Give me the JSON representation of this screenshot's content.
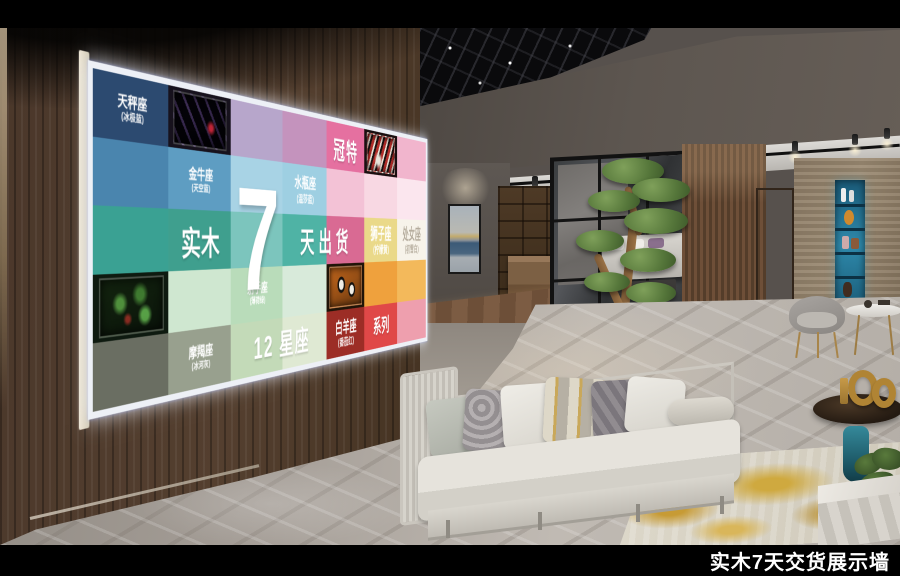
{
  "caption": "实木7天交货展示墙",
  "board": {
    "brand": "冠特",
    "headline_left": "实木",
    "headline_number": "7",
    "headline_right": "天出货",
    "footer_line": "12 星座",
    "series": "系列",
    "frame_color": "#edf0f6",
    "rows": [
      [
        {
          "c": "#2c4a70",
          "l": "天秤座",
          "s": "(冰极蓝)"
        },
        {
          "c": "#17121d",
          "n": "stripe-dark"
        },
        {
          "c": "#b7a6cb"
        },
        {
          "c": "#c493bd"
        },
        {
          "c": "#e570a0"
        },
        {
          "c": "#1a0f10",
          "n": "stripe-red"
        },
        {
          "c": "#f1b5cd"
        }
      ],
      [
        {
          "c": "#4a85ae"
        },
        {
          "c": "#5e9dc2",
          "l": "金牛座",
          "s": "(天空蓝)"
        },
        {
          "c": "#a8d3e5"
        },
        {
          "c": "#9ecfe2",
          "l": "水瓶座",
          "s": "(温莎蓝)"
        },
        {
          "c": "#f3c2d6"
        },
        {
          "c": "#f8d8e3"
        },
        {
          "c": "#fbe6ee"
        }
      ],
      [
        {
          "c": "#3aa193"
        },
        {
          "c": "#3f9f8e"
        },
        {
          "c": "#7cc5bd"
        },
        {
          "c": "#4fb3a5"
        },
        {
          "c": "#d96a93"
        },
        {
          "c": "#ead989",
          "l": "狮子座",
          "s": "(柠檬黄)"
        },
        {
          "c": "#f7f3ea",
          "l": "处女座",
          "s": "(初雪白)",
          "d": true
        }
      ],
      [
        {
          "c": "#0e1a10",
          "n": "plants"
        },
        {
          "c": "#cfe7d0"
        },
        {
          "c": "#b9dcba",
          "l": "射手座",
          "s": "(薄荷绿)"
        },
        {
          "c": "#d8eada"
        },
        {
          "c": "#201408",
          "n": "panda"
        },
        {
          "c": "#efa13d"
        },
        {
          "c": "#f3b95b"
        }
      ],
      [
        {
          "c": "#6a6e62"
        },
        {
          "c": "#98a08e",
          "l": "摩羯座",
          "s": "(冰河灰)"
        },
        {
          "c": "#c3dab8"
        },
        {
          "c": "#dfe9d3"
        },
        {
          "c": "#9c2d26",
          "l": "白羊座",
          "s": "(番茄红)"
        },
        {
          "c": "#e04848"
        },
        {
          "c": "#ee9fae"
        }
      ]
    ]
  }
}
